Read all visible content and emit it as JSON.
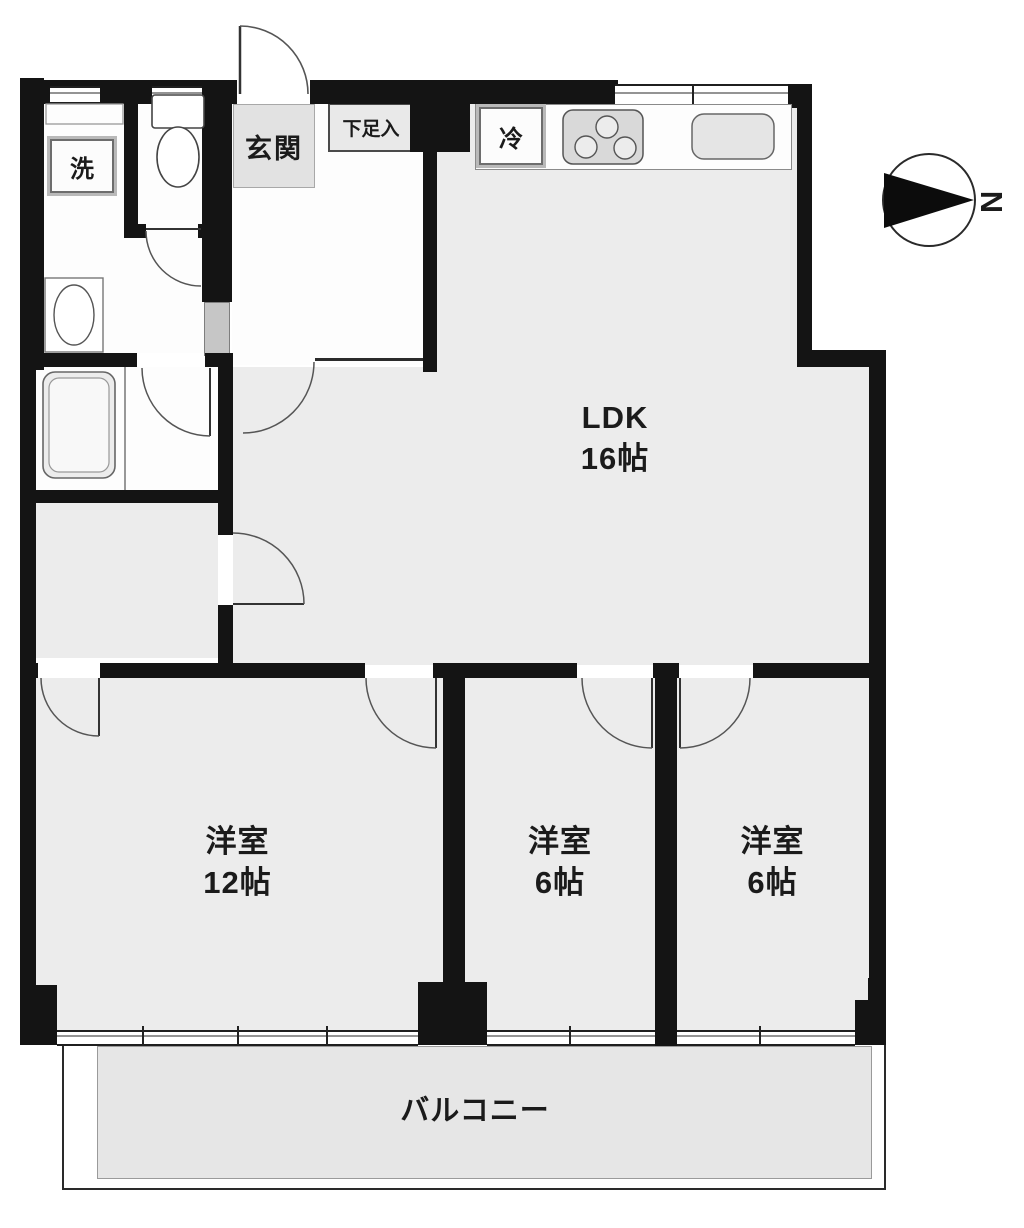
{
  "rooms": {
    "ldk": {
      "label": "LDK",
      "size": "16帖"
    },
    "bedroom_12": {
      "label": "洋室",
      "size": "12帖"
    },
    "bedroom_6_center": {
      "label": "洋室",
      "size": "6帖"
    },
    "bedroom_6_right": {
      "label": "洋室",
      "size": "6帖"
    },
    "balcony": {
      "label": "バルコニー"
    },
    "entrance": {
      "label": "玄関"
    },
    "shoe_storage": {
      "label": "下足入"
    }
  },
  "fixtures": {
    "washing_machine": {
      "label": "洗"
    },
    "refrigerator": {
      "label": "冷"
    }
  },
  "compass": {
    "north": "N"
  }
}
